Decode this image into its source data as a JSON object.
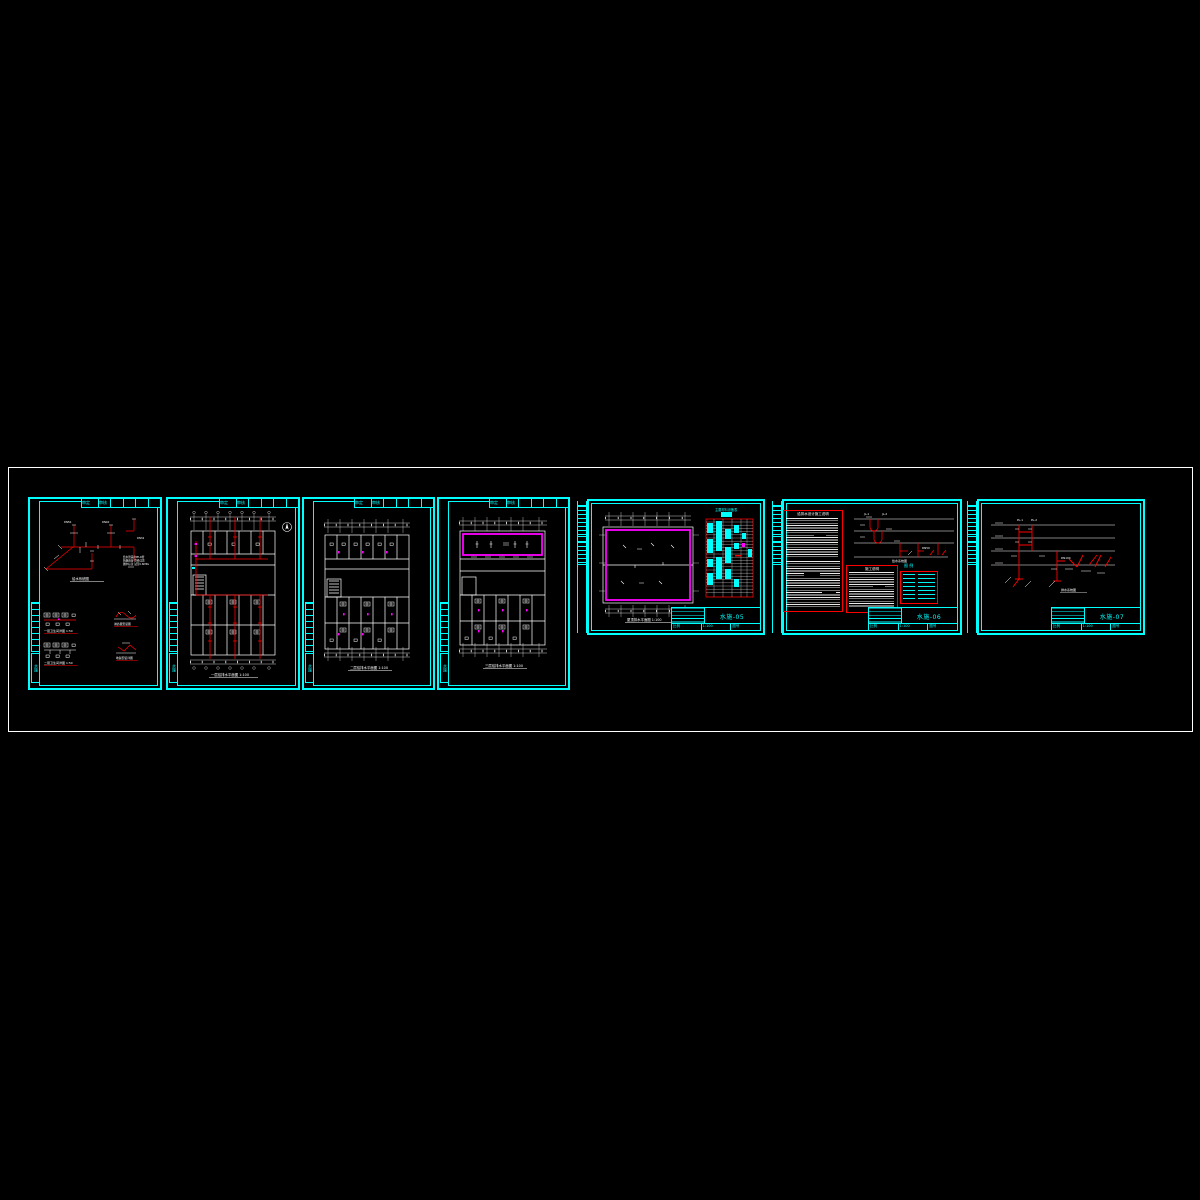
{
  "window": {
    "title": "CAD 给排水施工图",
    "background": "#000000"
  },
  "colors": {
    "frame": "#00ffff",
    "line": "#ffffff",
    "pipe": "#ff0000",
    "highlight": "#ff00ff",
    "paper_border": "#ffffff"
  },
  "sheet_header": {
    "cells": [
      "审定",
      "审核",
      "校对",
      "设计",
      "制图",
      "页次"
    ],
    "side_label": "水施"
  },
  "title_block": {
    "scale_label": "比例",
    "scale": "1:100",
    "no_label": "图号"
  },
  "sheets": [
    {
      "no": "水施-01",
      "captions": {
        "main": "给水系统图",
        "d1": "一层卫生间详图 1:50",
        "d2": "二层卫生间详图 1:50",
        "s1": "淋浴器安装图",
        "s2": "地漏安装详图"
      },
      "labels": {
        "l1": "DN50",
        "l2": "DN40",
        "l3": "DN32",
        "note1": "给水管采用PP-R管",
        "note2": "热熔连接 管径详见",
        "note3": "图中标注 试压0.6MPa"
      }
    },
    {
      "no": "水施-02",
      "captions": {
        "main": "一层给排水平面图 1:100"
      }
    },
    {
      "no": "水施-03",
      "captions": {
        "main": "二层给排水平面图 1:100"
      }
    },
    {
      "no": "水施-04",
      "captions": {
        "main": "三层给排水平面图 1:100"
      }
    },
    {
      "no": "水施-05",
      "captions": {
        "main": "屋顶排水平面图 1:100",
        "table": "主要材料设备表"
      }
    },
    {
      "no": "水施-06",
      "captions": {
        "notes": "给排水设计施工说明",
        "notes2": "施工说明",
        "legend": "图 例",
        "riser": "给水系统图"
      },
      "labels": {
        "l1": "JL-1",
        "l2": "JL-2",
        "l3": "DN50"
      }
    },
    {
      "no": "水施-07",
      "captions": {
        "main": "排水系统图"
      },
      "labels": {
        "l1": "PL-1",
        "l2": "PL-2",
        "l3": "DN100"
      }
    }
  ]
}
